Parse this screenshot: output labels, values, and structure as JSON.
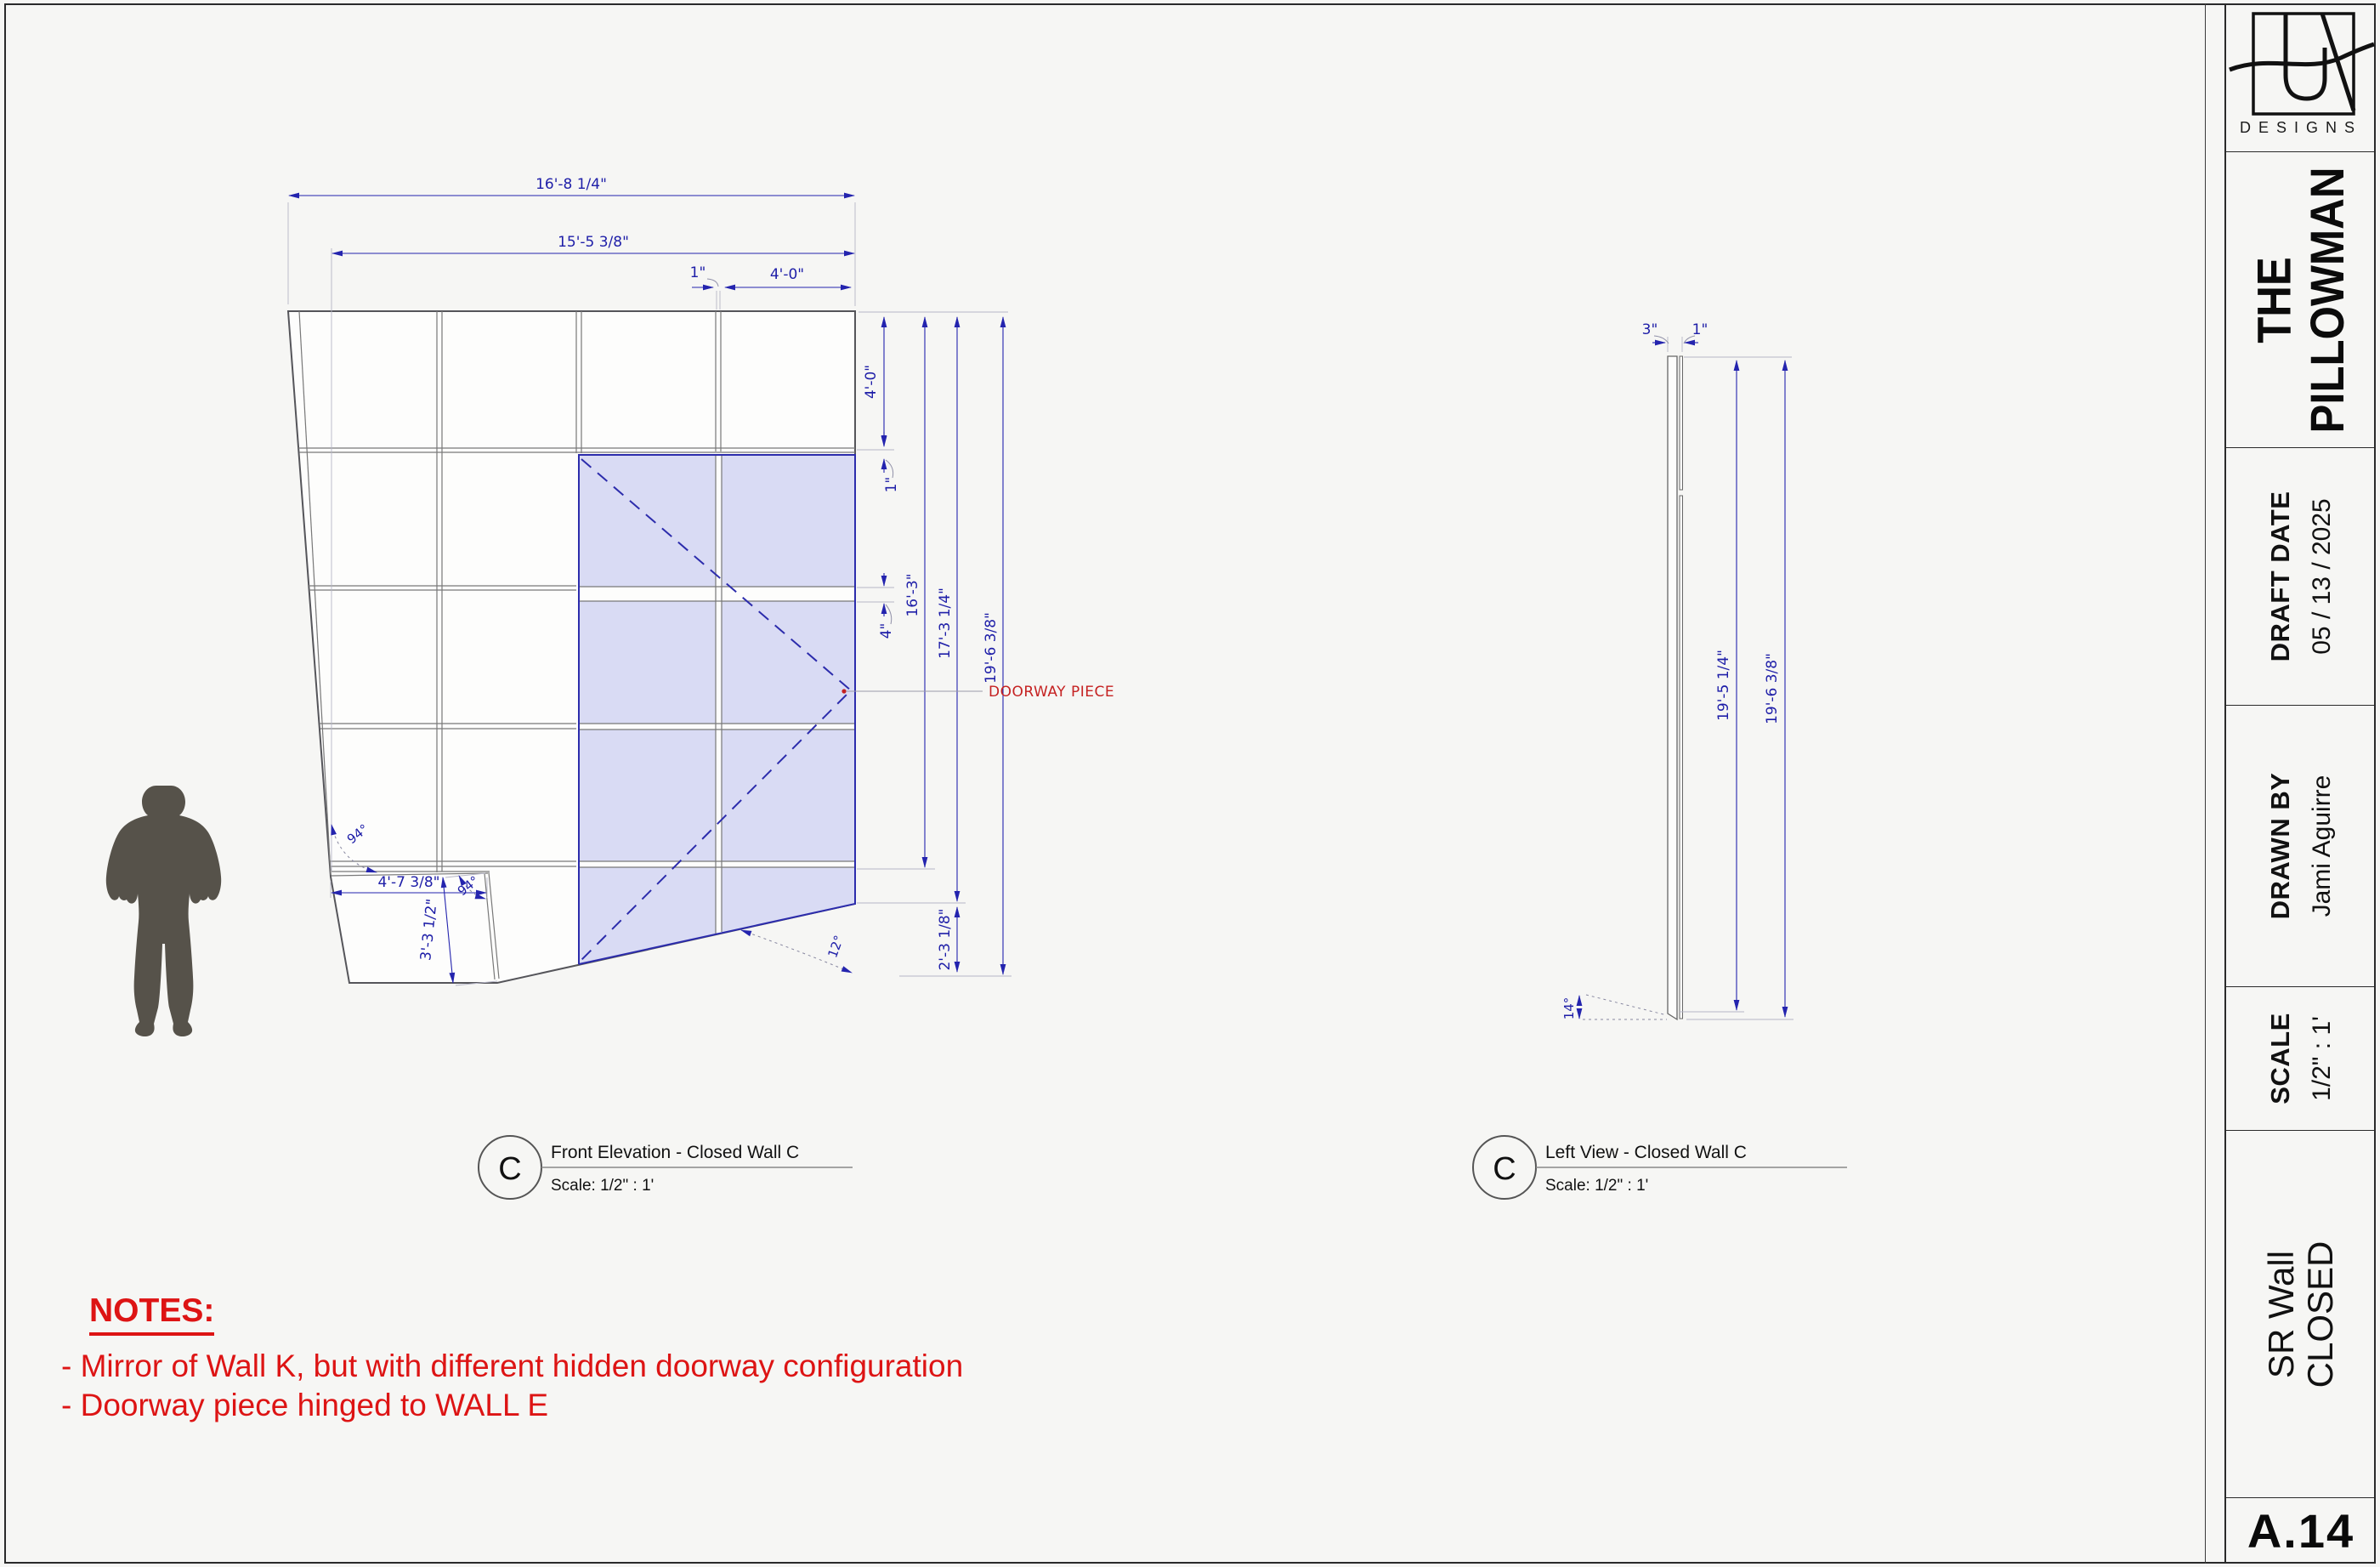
{
  "colors": {
    "dimension_blue": "#2424ae",
    "doorway_fill": "#d9dbf4",
    "annotation_red": "#dd1414",
    "silhouette_gray": "#56524a"
  },
  "title_block": {
    "brand": "DESIGNS",
    "project_line1": "THE",
    "project_line2": "PILLOWMAN",
    "draft_date_label": "DRAFT DATE",
    "draft_date_value": "05 / 13 / 2025",
    "drawn_by_label": "DRAWN BY",
    "drawn_by_value": "Jami Aguirre",
    "scale_label": "SCALE",
    "scale_value": "1/2\" : 1'",
    "sheet_name_line1": "SR Wall",
    "sheet_name_line2": "CLOSED",
    "sheet_number": "A.14"
  },
  "views": {
    "front": {
      "tag": "C",
      "title": "Front Elevation - Closed Wall C",
      "scale": "Scale:  1/2\" : 1'"
    },
    "left": {
      "tag": "C",
      "title": "Left View - Closed Wall C",
      "scale": "Scale:  1/2\" : 1'"
    }
  },
  "front_elevation": {
    "dim_overall_width": "16'-8 1/4\"",
    "dim_inner_width": "15'-5 3/8\"",
    "dim_top_gap": "1\"",
    "dim_top_panel": "4'-0\"",
    "dim_right_panel": "4'-0\"",
    "dim_right_gap": "1\"",
    "dim_mid_gap": "4\"",
    "dim_height_inner": "16'-3\"",
    "dim_height_mid": "17'-3 1/4\"",
    "dim_height_overall": "19'-6 3/8\"",
    "dim_bottom_right": "2'-3 1/8\"",
    "dim_bottom_width": "4'-7 3/8\"",
    "dim_bottom_edge": "3'-3 1/2\"",
    "angle_bottom_left": "94°",
    "angle_notch": "94°",
    "angle_bottom": "12°",
    "label_doorway": "DOORWAY PIECE"
  },
  "left_view": {
    "dim_thickness_wall": "3\"",
    "dim_thickness_piece": "1\"",
    "dim_height_inner": "19'-5 1/4\"",
    "dim_height_overall": "19'-6 3/8\"",
    "angle_bottom": "14°"
  },
  "notes": {
    "heading": "NOTES:",
    "item1": "- Mirror of Wall K, but with different hidden doorway configuration",
    "item2": "- Doorway piece hinged to WALL E"
  }
}
